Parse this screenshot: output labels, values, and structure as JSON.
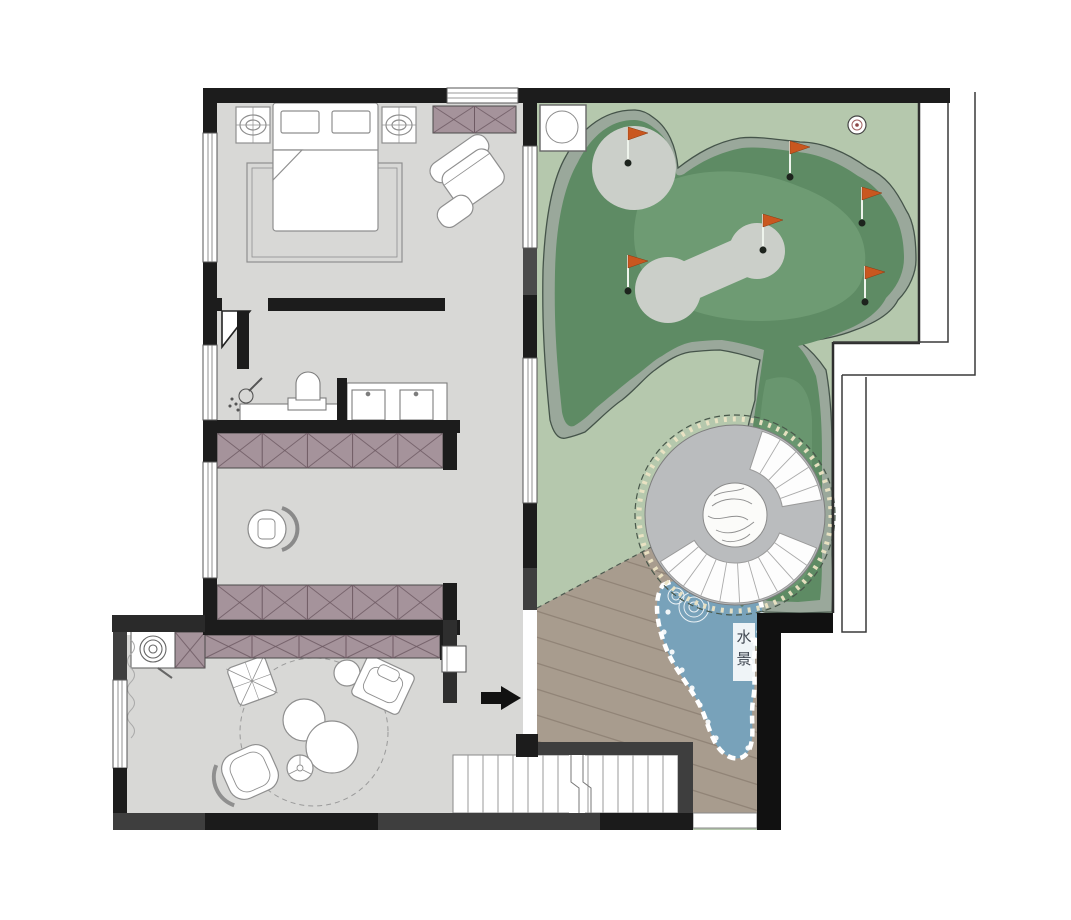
{
  "meta": {
    "type": "residential-floor-plan",
    "description": "second floor plan with roof terrace golf green, spiral feature, water feature and wood deck"
  },
  "labels": {
    "water_feature": [
      "水",
      "景"
    ]
  },
  "colors": {
    "wall": "#1c1c1c",
    "wall_secondary": "#3e3e3e",
    "floor": "#d8d8d6",
    "terrace": "#b5c8ad",
    "green_fringe": "#9aa89b",
    "green_dark": "#5e8b64",
    "green_light": "#719e76",
    "putting_gray": "#cbcfc9",
    "deck": "#a89c8e",
    "water": "#78a2ba",
    "wardrobe": "#a5939b",
    "wardrobe_line": "#6e5a63",
    "flag": "#c9571f",
    "flag_edge": "#8a3a12",
    "hole": "#1d241d",
    "pole": "#eef4ec"
  },
  "rooms": [
    {
      "name": "bedroom"
    },
    {
      "name": "bathroom"
    },
    {
      "name": "dressing-hall"
    },
    {
      "name": "tea-room"
    },
    {
      "name": "stair-hall"
    },
    {
      "name": "roof-terrace-golf-green"
    },
    {
      "name": "wood-deck"
    },
    {
      "name": "water-feature"
    }
  ],
  "terrace": {
    "golf": {
      "flags": [
        {
          "x": 628,
          "y": 163
        },
        {
          "x": 790,
          "y": 177
        },
        {
          "x": 862,
          "y": 223
        },
        {
          "x": 763,
          "y": 250
        },
        {
          "x": 628,
          "y": 291
        },
        {
          "x": 865,
          "y": 302
        }
      ],
      "putting_greens": 2
    },
    "spiral": {
      "cx": 735,
      "cy": 515,
      "r_inner": 48,
      "r_outer": 88,
      "fans": [
        [
          18,
          80
        ],
        [
          112,
          238
        ]
      ],
      "tick_step": 13
    }
  },
  "wardrobes": [
    {
      "x": 433,
      "y": 106,
      "w": 83,
      "h": 27,
      "cells": 2
    },
    {
      "x": 217,
      "y": 433,
      "w": 226,
      "h": 35,
      "cells": 5
    },
    {
      "x": 217,
      "y": 585,
      "w": 226,
      "h": 35,
      "cells": 5
    },
    {
      "x": 205,
      "y": 635,
      "w": 235,
      "h": 23,
      "cells": 5
    },
    {
      "x": 175,
      "y": 632,
      "w": 30,
      "h": 36,
      "cells": 1
    }
  ],
  "stairs": {
    "treads": 14,
    "x": 453,
    "y": 755,
    "w": 225,
    "h": 58
  }
}
